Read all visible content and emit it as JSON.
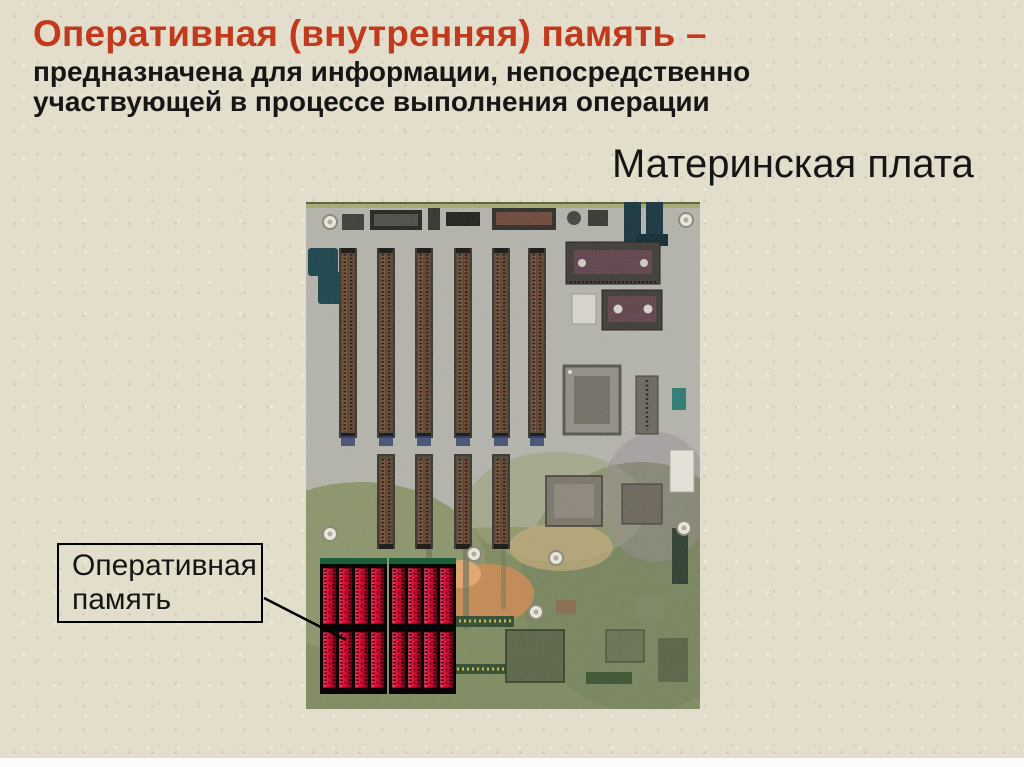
{
  "slide": {
    "title": "Оперативная (внутренняя) память –",
    "subtitle_lines": [
      "предназначена для информации, непосредственно",
      "участвующей в процессе выполнения операции"
    ],
    "caption": "Материнская плата",
    "callout_label": "Оперативная память",
    "illustration": "motherboard-photo-with-ram-highlighted",
    "colors": {
      "background": "#e3decb",
      "title_red": "#c23a1d",
      "body_text": "#161616",
      "ram_highlight": "#d81236",
      "board_gray": "#b4b3ab",
      "board_olive": "#84905f",
      "callout_border": "#000000",
      "bottom_strip": "#fcfcfa"
    }
  }
}
